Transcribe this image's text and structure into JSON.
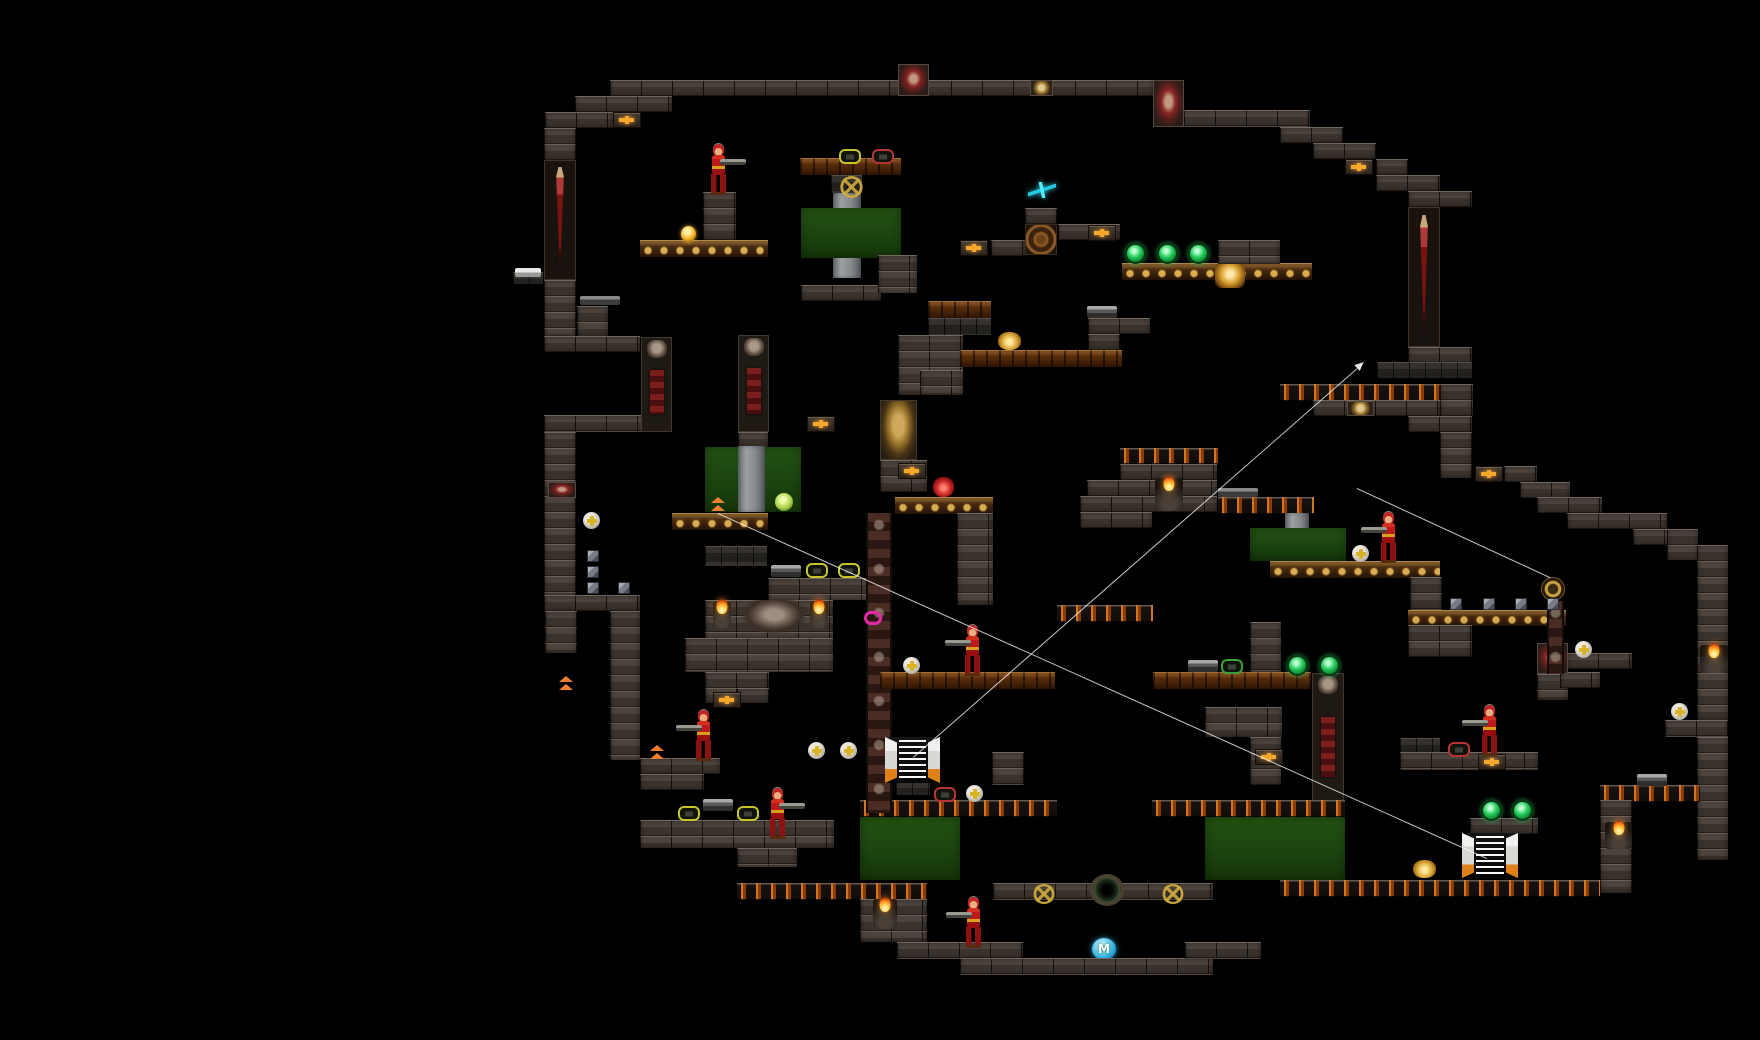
{
  "meta": {
    "app": "gothic-platformer-level-map",
    "canvas": {
      "width": 1760,
      "height": 1040
    },
    "background_color": "#000000"
  },
  "palette": {
    "brick": "#4c433d",
    "cobble": "#2f2c28",
    "wood_platform": "#5a2e0c",
    "skull_frieze_gold": "#d8b050",
    "lava_slot_orange": "#d4741c",
    "door_green": "#1d4a10",
    "door_column_gray": "#9aa0a4",
    "sword_red": "#7a1212",
    "flame_orange": "#ff8c1a",
    "gem_green": "#2ad062",
    "health_gold": "#f5a82c",
    "shuriken_cyan": "#40e8f8",
    "ring_magenta": "#e428a8",
    "m_sphere_blue": "#30b0e0",
    "link_line_white": "#ffffff"
  },
  "legend": {
    "t-brick": "stone brick wall/platform",
    "t-cobble": "dark cobble block",
    "t-wood": "wooden plank platform",
    "t-skullfrieze": "gold skull frieze platform",
    "t-lavaslot": "dark platform with orange slots",
    "t-greendoor": "green door field",
    "t-graycol": "door guide column",
    "t-swordcol": "sword wall pillar",
    "t-skullcol": "skull pillar",
    "t-ornatecol": "ornate bone pillar",
    "t-emblemface": "gold demon-face emblem",
    "t-wheelemblem": "carved wheel emblem"
  },
  "terrain": [
    {
      "t": "t-brick",
      "x": 610,
      "y": 80,
      "w": 543,
      "h": 16
    },
    {
      "t": "t-brick",
      "x": 575,
      "y": 96,
      "w": 97,
      "h": 16
    },
    {
      "t": "t-brick",
      "x": 545,
      "y": 112,
      "w": 68,
      "h": 16
    },
    {
      "t": "t-brick",
      "x": 544,
      "y": 128,
      "w": 32,
      "h": 32
    },
    {
      "t": "t-swordcol",
      "x": 544,
      "y": 160,
      "w": 32,
      "h": 120
    },
    {
      "t": "t-brick",
      "x": 544,
      "y": 280,
      "w": 32,
      "h": 56
    },
    {
      "t": "t-brick",
      "x": 577,
      "y": 306,
      "w": 31,
      "h": 30
    },
    {
      "t": "t-brick",
      "x": 544,
      "y": 336,
      "w": 96,
      "h": 16
    },
    {
      "t": "t-brick",
      "x": 544,
      "y": 415,
      "w": 128,
      "h": 17
    },
    {
      "t": "t-brick",
      "x": 544,
      "y": 432,
      "w": 32,
      "h": 163
    },
    {
      "t": "t-brick",
      "x": 544,
      "y": 595,
      "w": 96,
      "h": 16
    },
    {
      "t": "t-brick",
      "x": 545,
      "y": 611,
      "w": 32,
      "h": 42
    },
    {
      "t": "t-brick",
      "x": 610,
      "y": 611,
      "w": 30,
      "h": 149
    },
    {
      "t": "t-brick",
      "x": 640,
      "y": 758,
      "w": 80,
      "h": 16
    },
    {
      "t": "t-brick",
      "x": 640,
      "y": 774,
      "w": 64,
      "h": 16
    },
    {
      "t": "t-brick",
      "x": 640,
      "y": 820,
      "w": 194,
      "h": 28
    },
    {
      "t": "t-brick",
      "x": 737,
      "y": 848,
      "w": 60,
      "h": 19
    },
    {
      "t": "t-lavaslot",
      "x": 737,
      "y": 883,
      "w": 190,
      "h": 17
    },
    {
      "t": "t-brick",
      "x": 703,
      "y": 192,
      "w": 33,
      "h": 48
    },
    {
      "t": "t-skullfrieze",
      "x": 640,
      "y": 240,
      "w": 128,
      "h": 17
    },
    {
      "t": "t-cobble",
      "x": 513,
      "y": 272,
      "w": 30,
      "h": 12
    },
    {
      "t": "t-wood",
      "x": 800,
      "y": 158,
      "w": 101,
      "h": 17
    },
    {
      "t": "t-cobble",
      "x": 831,
      "y": 175,
      "w": 31,
      "h": 18
    },
    {
      "t": "t-graycol",
      "x": 833,
      "y": 193,
      "w": 28,
      "h": 85
    },
    {
      "t": "t-greendoor",
      "x": 801,
      "y": 208,
      "w": 100,
      "h": 50
    },
    {
      "t": "t-brick",
      "x": 801,
      "y": 285,
      "w": 80,
      "h": 16
    },
    {
      "t": "t-brick",
      "x": 878,
      "y": 255,
      "w": 39,
      "h": 38
    },
    {
      "t": "t-wood",
      "x": 928,
      "y": 301,
      "w": 63,
      "h": 17
    },
    {
      "t": "t-cobble",
      "x": 928,
      "y": 318,
      "w": 63,
      "h": 17
    },
    {
      "t": "t-brick",
      "x": 898,
      "y": 335,
      "w": 65,
      "h": 60
    },
    {
      "t": "t-brick",
      "x": 920,
      "y": 370,
      "w": 43,
      "h": 25
    },
    {
      "t": "t-emblemface",
      "x": 880,
      "y": 400,
      "w": 37,
      "h": 60
    },
    {
      "t": "t-brick",
      "x": 880,
      "y": 460,
      "w": 47,
      "h": 32
    },
    {
      "t": "t-skullfrieze",
      "x": 895,
      "y": 497,
      "w": 98,
      "h": 17
    },
    {
      "t": "t-brick",
      "x": 957,
      "y": 513,
      "w": 36,
      "h": 92
    },
    {
      "t": "t-wood",
      "x": 960,
      "y": 350,
      "w": 162,
      "h": 17
    },
    {
      "t": "t-brick",
      "x": 1088,
      "y": 318,
      "w": 62,
      "h": 16
    },
    {
      "t": "t-brick",
      "x": 1088,
      "y": 334,
      "w": 32,
      "h": 16
    },
    {
      "t": "t-lavaslot",
      "x": 1057,
      "y": 605,
      "w": 96,
      "h": 17
    },
    {
      "t": "t-brick",
      "x": 991,
      "y": 240,
      "w": 34,
      "h": 16
    },
    {
      "t": "t-brick",
      "x": 1025,
      "y": 208,
      "w": 32,
      "h": 16
    },
    {
      "t": "t-wheelemblem",
      "x": 1025,
      "y": 224,
      "w": 32,
      "h": 31
    },
    {
      "t": "t-brick",
      "x": 1058,
      "y": 224,
      "w": 62,
      "h": 16
    },
    {
      "t": "t-skullfrieze",
      "x": 1122,
      "y": 263,
      "w": 190,
      "h": 17
    },
    {
      "t": "t-brick",
      "x": 1218,
      "y": 240,
      "w": 62,
      "h": 24
    },
    {
      "t": "t-brick",
      "x": 1153,
      "y": 110,
      "w": 157,
      "h": 17
    },
    {
      "t": "t-brick",
      "x": 1280,
      "y": 127,
      "w": 63,
      "h": 16
    },
    {
      "t": "t-brick",
      "x": 1313,
      "y": 143,
      "w": 63,
      "h": 16
    },
    {
      "t": "t-brick",
      "x": 1376,
      "y": 159,
      "w": 32,
      "h": 16
    },
    {
      "t": "t-brick",
      "x": 1376,
      "y": 175,
      "w": 64,
      "h": 16
    },
    {
      "t": "t-brick",
      "x": 1408,
      "y": 191,
      "w": 64,
      "h": 16
    },
    {
      "t": "t-swordcol",
      "x": 1408,
      "y": 207,
      "w": 32,
      "h": 140
    },
    {
      "t": "t-brick",
      "x": 1408,
      "y": 347,
      "w": 64,
      "h": 16
    },
    {
      "t": "t-cobble",
      "x": 1377,
      "y": 362,
      "w": 95,
      "h": 16
    },
    {
      "t": "t-lavaslot",
      "x": 1280,
      "y": 384,
      "w": 160,
      "h": 17
    },
    {
      "t": "t-brick",
      "x": 1313,
      "y": 400,
      "w": 127,
      "h": 16
    },
    {
      "t": "t-brick",
      "x": 1440,
      "y": 384,
      "w": 33,
      "h": 32
    },
    {
      "t": "t-brick",
      "x": 1408,
      "y": 416,
      "w": 64,
      "h": 16
    },
    {
      "t": "t-brick",
      "x": 1440,
      "y": 432,
      "w": 32,
      "h": 46
    },
    {
      "t": "t-brick",
      "x": 1504,
      "y": 466,
      "w": 33,
      "h": 16
    },
    {
      "t": "t-brick",
      "x": 1520,
      "y": 482,
      "w": 50,
      "h": 16
    },
    {
      "t": "t-brick",
      "x": 1537,
      "y": 497,
      "w": 65,
      "h": 16
    },
    {
      "t": "t-brick",
      "x": 1567,
      "y": 513,
      "w": 100,
      "h": 16
    },
    {
      "t": "t-brick",
      "x": 1633,
      "y": 529,
      "w": 65,
      "h": 16
    },
    {
      "t": "t-brick",
      "x": 1667,
      "y": 529,
      "w": 31,
      "h": 31
    },
    {
      "t": "t-brick",
      "x": 1697,
      "y": 545,
      "w": 31,
      "h": 175
    },
    {
      "t": "t-brick",
      "x": 1665,
      "y": 720,
      "w": 63,
      "h": 17
    },
    {
      "t": "t-brick",
      "x": 1697,
      "y": 737,
      "w": 31,
      "h": 123
    },
    {
      "t": "t-lavaslot",
      "x": 1120,
      "y": 448,
      "w": 98,
      "h": 16
    },
    {
      "t": "t-brick",
      "x": 1120,
      "y": 464,
      "w": 97,
      "h": 16
    },
    {
      "t": "t-brick",
      "x": 1087,
      "y": 480,
      "w": 130,
      "h": 16
    },
    {
      "t": "t-brick",
      "x": 1080,
      "y": 496,
      "w": 137,
      "h": 16
    },
    {
      "t": "t-brick",
      "x": 1080,
      "y": 512,
      "w": 72,
      "h": 16
    },
    {
      "t": "t-lavaslot",
      "x": 1218,
      "y": 497,
      "w": 96,
      "h": 17
    },
    {
      "t": "t-graycol",
      "x": 1285,
      "y": 513,
      "w": 24,
      "h": 48
    },
    {
      "t": "t-greendoor",
      "x": 1250,
      "y": 528,
      "w": 96,
      "h": 33
    },
    {
      "t": "t-skullfrieze",
      "x": 1270,
      "y": 561,
      "w": 170,
      "h": 17
    },
    {
      "t": "t-brick",
      "x": 1410,
      "y": 577,
      "w": 32,
      "h": 33
    },
    {
      "t": "t-skullfrieze",
      "x": 1408,
      "y": 610,
      "w": 158,
      "h": 16
    },
    {
      "t": "t-brick",
      "x": 1408,
      "y": 625,
      "w": 64,
      "h": 32
    },
    {
      "t": "t-cobble",
      "x": 1400,
      "y": 738,
      "w": 40,
      "h": 15
    },
    {
      "t": "t-brick",
      "x": 1400,
      "y": 752,
      "w": 138,
      "h": 18
    },
    {
      "t": "t-brick",
      "x": 1470,
      "y": 818,
      "w": 68,
      "h": 16
    },
    {
      "t": "t-brick",
      "x": 1537,
      "y": 674,
      "w": 31,
      "h": 26
    },
    {
      "t": "t-brick",
      "x": 1567,
      "y": 653,
      "w": 65,
      "h": 16
    },
    {
      "t": "t-brick",
      "x": 1560,
      "y": 672,
      "w": 40,
      "h": 16
    },
    {
      "t": "t-lavaslot",
      "x": 1600,
      "y": 785,
      "w": 100,
      "h": 17
    },
    {
      "t": "t-brick",
      "x": 1600,
      "y": 800,
      "w": 32,
      "h": 93
    },
    {
      "t": "t-lavaslot",
      "x": 1280,
      "y": 880,
      "w": 320,
      "h": 17
    },
    {
      "t": "t-wood",
      "x": 1153,
      "y": 672,
      "w": 158,
      "h": 17
    },
    {
      "t": "t-brick",
      "x": 1250,
      "y": 622,
      "w": 31,
      "h": 50
    },
    {
      "t": "t-skullcol",
      "x": 1312,
      "y": 673,
      "w": 32,
      "h": 128
    },
    {
      "t": "t-brick",
      "x": 1205,
      "y": 707,
      "w": 77,
      "h": 30
    },
    {
      "t": "t-brick",
      "x": 1250,
      "y": 737,
      "w": 31,
      "h": 48
    },
    {
      "t": "t-brick",
      "x": 992,
      "y": 752,
      "w": 32,
      "h": 33
    },
    {
      "t": "t-lavaslot",
      "x": 1152,
      "y": 800,
      "w": 193,
      "h": 17
    },
    {
      "t": "t-graycol",
      "x": 1283,
      "y": 817,
      "w": 27,
      "h": 63
    },
    {
      "t": "t-greendoor",
      "x": 1205,
      "y": 817,
      "w": 140,
      "h": 63
    },
    {
      "t": "t-lavaslot",
      "x": 860,
      "y": 800,
      "w": 197,
      "h": 17
    },
    {
      "t": "t-graycol",
      "x": 898,
      "y": 817,
      "w": 29,
      "h": 63
    },
    {
      "t": "t-greendoor",
      "x": 860,
      "y": 817,
      "w": 100,
      "h": 63
    },
    {
      "t": "t-brick",
      "x": 860,
      "y": 899,
      "w": 67,
      "h": 43
    },
    {
      "t": "t-brick",
      "x": 993,
      "y": 883,
      "w": 220,
      "h": 17
    },
    {
      "t": "t-brick",
      "x": 897,
      "y": 942,
      "w": 126,
      "h": 17
    },
    {
      "t": "t-brick",
      "x": 960,
      "y": 958,
      "w": 253,
      "h": 17
    },
    {
      "t": "t-brick",
      "x": 1185,
      "y": 942,
      "w": 76,
      "h": 17
    },
    {
      "t": "t-brick",
      "x": 705,
      "y": 600,
      "w": 128,
      "h": 38
    },
    {
      "t": "t-brick",
      "x": 685,
      "y": 638,
      "w": 148,
      "h": 34
    },
    {
      "t": "t-brick",
      "x": 705,
      "y": 672,
      "w": 64,
      "h": 31
    },
    {
      "t": "t-brick",
      "x": 737,
      "y": 688,
      "w": 32,
      "h": 15
    },
    {
      "t": "t-skullfrieze",
      "x": 672,
      "y": 513,
      "w": 96,
      "h": 17
    },
    {
      "t": "t-cobble",
      "x": 705,
      "y": 546,
      "w": 62,
      "h": 20
    },
    {
      "t": "t-brick",
      "x": 738,
      "y": 432,
      "w": 30,
      "h": 15
    },
    {
      "t": "t-greendoor",
      "x": 705,
      "y": 447,
      "w": 96,
      "h": 65
    },
    {
      "t": "t-graycol",
      "x": 738,
      "y": 446,
      "w": 27,
      "h": 66
    },
    {
      "t": "t-skullcol",
      "x": 641,
      "y": 337,
      "w": 31,
      "h": 95
    },
    {
      "t": "t-skullcol",
      "x": 738,
      "y": 335,
      "w": 31,
      "h": 97
    },
    {
      "t": "t-brick",
      "x": 768,
      "y": 578,
      "w": 112,
      "h": 22
    },
    {
      "t": "t-ornatecol",
      "x": 866,
      "y": 513,
      "w": 26,
      "h": 300
    },
    {
      "t": "t-wood",
      "x": 880,
      "y": 672,
      "w": 175,
      "h": 17
    },
    {
      "t": "t-cobble",
      "x": 896,
      "y": 781,
      "w": 34,
      "h": 14
    }
  ],
  "decor": [
    {
      "t": "d-goat",
      "x": 898,
      "y": 64,
      "w": 31,
      "h": 32
    },
    {
      "t": "d-skullblk",
      "x": 1030,
      "y": 80,
      "w": 23,
      "h": 16
    },
    {
      "t": "d-goat",
      "x": 1153,
      "y": 80,
      "w": 31,
      "h": 47
    },
    {
      "t": "d-skullblk",
      "x": 1347,
      "y": 401,
      "w": 27,
      "h": 15
    },
    {
      "t": "d-goat",
      "x": 1537,
      "y": 643,
      "w": 31,
      "h": 31
    },
    {
      "t": "d-goat",
      "x": 548,
      "y": 482,
      "w": 28,
      "h": 16
    },
    {
      "t": "d-skullhead",
      "x": 1215,
      "y": 264,
      "w": 30,
      "h": 24
    },
    {
      "t": "d-goatart",
      "x": 743,
      "y": 600,
      "w": 62,
      "h": 33
    },
    {
      "t": "d-torch",
      "x": 713,
      "y": 601,
      "w": 18,
      "h": 27
    },
    {
      "t": "d-torch",
      "x": 810,
      "y": 601,
      "w": 18,
      "h": 27
    },
    {
      "t": "d-torch",
      "x": 1155,
      "y": 478,
      "w": 28,
      "h": 33
    },
    {
      "t": "d-torch",
      "x": 873,
      "y": 899,
      "w": 24,
      "h": 30
    },
    {
      "t": "d-torch",
      "x": 1605,
      "y": 822,
      "w": 27,
      "h": 27
    },
    {
      "t": "d-torch",
      "x": 1700,
      "y": 645,
      "w": 28,
      "h": 28
    },
    {
      "t": "d-pentagram",
      "x": 840,
      "y": 176,
      "w": 23,
      "h": 22
    },
    {
      "t": "d-pentagram",
      "x": 1033,
      "y": 884,
      "w": 22,
      "h": 20
    },
    {
      "t": "d-pentagram",
      "x": 1162,
      "y": 884,
      "w": 22,
      "h": 20
    },
    {
      "t": "d-wheelsm",
      "x": 1541,
      "y": 577,
      "w": 24,
      "h": 24
    },
    {
      "t": "t-ornatecol",
      "x": 1547,
      "y": 601,
      "w": 17,
      "h": 73
    },
    {
      "t": "d-portal",
      "x": 1090,
      "y": 874,
      "w": 34,
      "h": 32
    }
  ],
  "items": {
    "plus_block": [
      [
        613,
        112
      ],
      [
        1345,
        159
      ],
      [
        960,
        240
      ],
      [
        1088,
        225
      ],
      [
        807,
        416
      ],
      [
        898,
        463
      ],
      [
        713,
        692
      ],
      [
        1255,
        749
      ],
      [
        1478,
        754
      ],
      [
        1475,
        466
      ]
    ],
    "plus_orb": [
      [
        583,
        512
      ],
      [
        903,
        657
      ],
      [
        808,
        742
      ],
      [
        840,
        742
      ],
      [
        966,
        785
      ],
      [
        1352,
        545
      ],
      [
        1575,
        641
      ],
      [
        1671,
        703
      ]
    ],
    "gem": [
      [
        1125,
        243
      ],
      [
        1157,
        243
      ],
      [
        1188,
        243
      ],
      [
        1287,
        655
      ],
      [
        1319,
        655
      ],
      [
        1481,
        800
      ],
      [
        1512,
        800
      ]
    ],
    "gold_orb": [
      [
        681,
        226
      ]
    ],
    "green_orb": [
      [
        775,
        493
      ]
    ],
    "frame_yellow": [
      [
        839,
        149
      ],
      [
        806,
        563
      ],
      [
        838,
        563
      ],
      [
        678,
        806
      ],
      [
        737,
        806
      ]
    ],
    "frame_red": [
      [
        872,
        149
      ],
      [
        934,
        787
      ],
      [
        1448,
        742
      ]
    ],
    "frame_green": [
      [
        1221,
        659
      ]
    ],
    "gun": [
      [
        771,
        565
      ],
      [
        703,
        799
      ],
      [
        1188,
        660
      ],
      [
        1637,
        774
      ],
      [
        1087,
        306
      ]
    ],
    "rifle": [
      [
        580,
        296
      ],
      [
        1218,
        488
      ]
    ],
    "gun_white": [
      [
        515,
        268
      ]
    ],
    "shuriken": [
      [
        1028,
        182
      ]
    ],
    "magenta_ring": [
      [
        864,
        611
      ]
    ],
    "imp_red": [
      [
        933,
        477
      ]
    ],
    "imp_gold": [
      [
        998,
        332
      ],
      [
        1413,
        860
      ]
    ],
    "cube": [
      [
        587,
        550
      ],
      [
        587,
        566
      ],
      [
        587,
        582
      ],
      [
        618,
        582
      ],
      [
        1450,
        598
      ],
      [
        1483,
        598
      ],
      [
        1515,
        598
      ],
      [
        1547,
        598
      ]
    ],
    "jump_pad": [
      [
        710,
        497
      ],
      [
        558,
        676
      ],
      [
        649,
        745
      ],
      [
        901,
        765
      ]
    ]
  },
  "soldiers": [
    {
      "x": 707,
      "y": 144,
      "dir": "r"
    },
    {
      "x": 961,
      "y": 625,
      "dir": "l"
    },
    {
      "x": 1377,
      "y": 512,
      "dir": "l"
    },
    {
      "x": 1478,
      "y": 705,
      "dir": "l"
    },
    {
      "x": 766,
      "y": 788,
      "dir": "r"
    },
    {
      "x": 692,
      "y": 710,
      "dir": "l"
    },
    {
      "x": 962,
      "y": 897,
      "dir": "l"
    }
  ],
  "teleporters": [
    {
      "x": 885,
      "y": 737,
      "w": 55,
      "h": 46
    },
    {
      "x": 1462,
      "y": 833,
      "w": 56,
      "h": 45
    }
  ],
  "entities": {
    "m_sphere": {
      "x": 1092,
      "y": 938,
      "w": 24,
      "h": 22,
      "label": "M"
    }
  },
  "links": [
    {
      "x1": 913,
      "y1": 757,
      "x2": 1357,
      "y2": 368,
      "arrow": true
    },
    {
      "x1": 718,
      "y1": 513,
      "x2": 1487,
      "y2": 858,
      "arrow": false
    },
    {
      "x1": 1357,
      "y1": 488,
      "x2": 1550,
      "y2": 577,
      "arrow": false
    }
  ]
}
